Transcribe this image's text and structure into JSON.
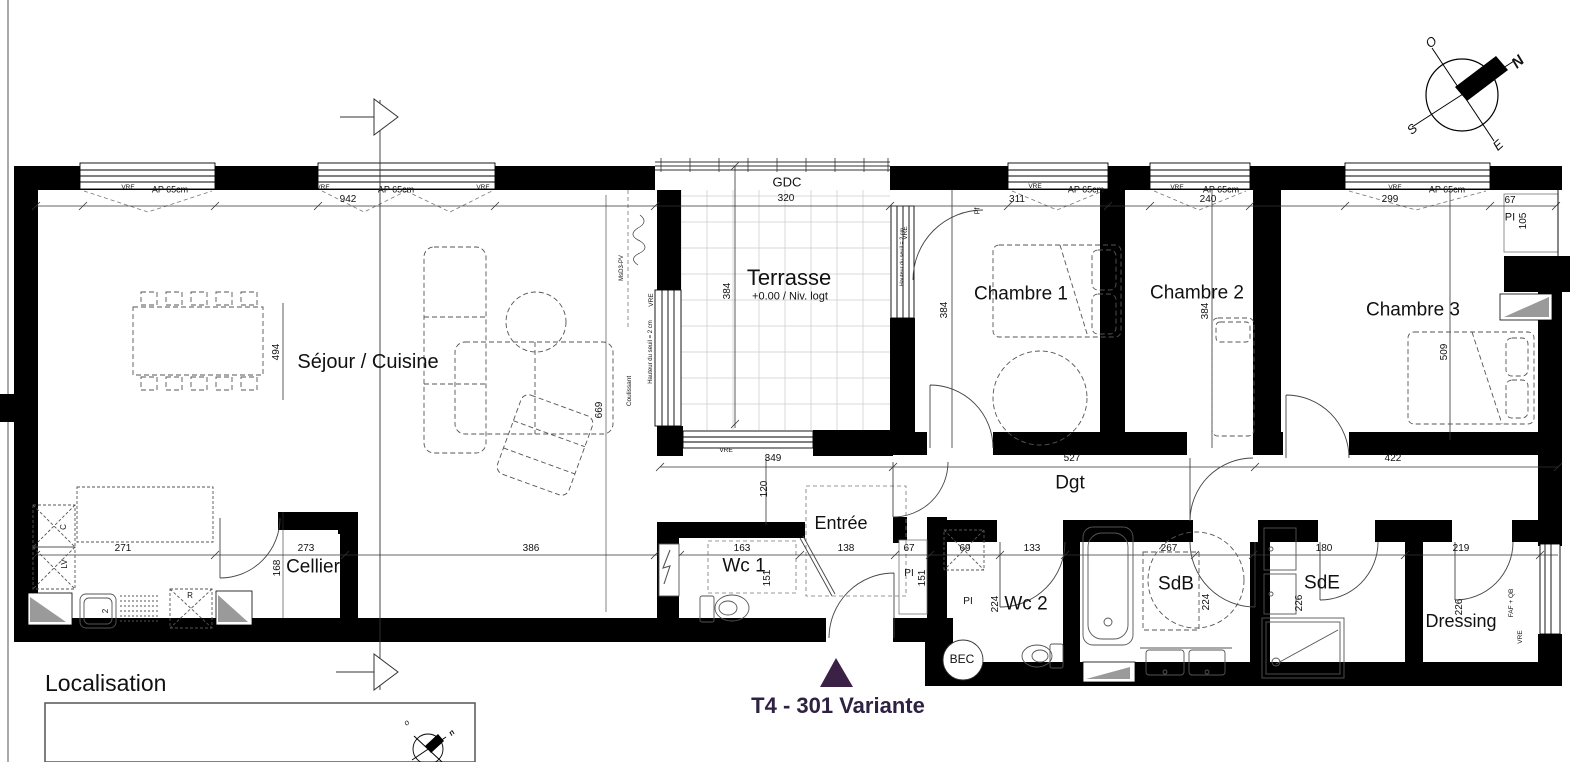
{
  "colors": {
    "wall": "#000000",
    "title": "#2f2142",
    "triangle": "#3a2145",
    "line": "#333333",
    "furniture": "#555555",
    "grid": "#cccccc",
    "gray_fill": "#9a9a9a"
  },
  "title_block": {
    "variant_title": "T4 - 301 Variante"
  },
  "localisation": {
    "heading": "Localisation"
  },
  "compass": {
    "north": "N",
    "south": "S",
    "east": "E",
    "west": "O"
  },
  "plan": {
    "labels": [
      {
        "n": "sejour-cuisine-label",
        "t": "Séjour / Cuisine",
        "x": 368,
        "y": 362,
        "s": 20
      },
      {
        "n": "cellier-label",
        "t": "Cellier",
        "x": 313,
        "y": 567,
        "s": 19
      },
      {
        "n": "terrasse-label",
        "t": "Terrasse",
        "x": 789,
        "y": 278,
        "s": 22
      },
      {
        "n": "terrasse-level-label",
        "t": "+0.00 / Niv. logt",
        "x": 790,
        "y": 297,
        "s": 11
      },
      {
        "n": "gdc-label",
        "t": "GDC",
        "x": 787,
        "y": 182,
        "s": 13
      },
      {
        "n": "chambre1-label",
        "t": "Chambre 1",
        "x": 1021,
        "y": 294,
        "s": 19
      },
      {
        "n": "chambre2-label",
        "t": "Chambre 2",
        "x": 1197,
        "y": 293,
        "s": 19
      },
      {
        "n": "chambre3-label",
        "t": "Chambre 3",
        "x": 1413,
        "y": 310,
        "s": 19
      },
      {
        "n": "dgt-label",
        "t": "Dgt",
        "x": 1070,
        "y": 483,
        "s": 19
      },
      {
        "n": "entree-label",
        "t": "Entrée",
        "x": 841,
        "y": 523,
        "s": 18
      },
      {
        "n": "wc1-label",
        "t": "Wc 1",
        "x": 744,
        "y": 566,
        "s": 19
      },
      {
        "n": "wc2-label",
        "t": "Wc 2",
        "x": 1026,
        "y": 604,
        "s": 19
      },
      {
        "n": "sdb-label",
        "t": "SdB",
        "x": 1176,
        "y": 584,
        "s": 19
      },
      {
        "n": "sde-label",
        "t": "SdE",
        "x": 1322,
        "y": 583,
        "s": 19
      },
      {
        "n": "dressing-label",
        "t": "Dressing",
        "x": 1461,
        "y": 621,
        "s": 18
      },
      {
        "n": "bec-label",
        "t": "BEC",
        "x": 962,
        "y": 659,
        "s": 12
      },
      {
        "n": "dim-942",
        "t": "942",
        "x": 348,
        "y": 200,
        "s": 10
      },
      {
        "n": "dim-320",
        "t": "320",
        "x": 786,
        "y": 199,
        "s": 10
      },
      {
        "n": "dim-311",
        "t": "311",
        "x": 1017,
        "y": 200,
        "s": 10
      },
      {
        "n": "dim-240",
        "t": "240",
        "x": 1208,
        "y": 200,
        "s": 10
      },
      {
        "n": "dim-299",
        "t": "299",
        "x": 1390,
        "y": 200,
        "s": 10
      },
      {
        "n": "dim-67-top",
        "t": "67",
        "x": 1510,
        "y": 201,
        "s": 10
      },
      {
        "n": "dim-349",
        "t": "349",
        "x": 773,
        "y": 459,
        "s": 10
      },
      {
        "n": "dim-527",
        "t": "527",
        "x": 1072,
        "y": 459,
        "s": 10
      },
      {
        "n": "dim-422",
        "t": "422",
        "x": 1393,
        "y": 459,
        "s": 10
      },
      {
        "n": "dim-271",
        "t": "271",
        "x": 123,
        "y": 549,
        "s": 10
      },
      {
        "n": "dim-273",
        "t": "273",
        "x": 306,
        "y": 549,
        "s": 10
      },
      {
        "n": "dim-386",
        "t": "386",
        "x": 531,
        "y": 549,
        "s": 10
      },
      {
        "n": "dim-163",
        "t": "163",
        "x": 742,
        "y": 549,
        "s": 10
      },
      {
        "n": "dim-138",
        "t": "138",
        "x": 846,
        "y": 549,
        "s": 10
      },
      {
        "n": "dim-67-entree",
        "t": "67",
        "x": 909,
        "y": 549,
        "s": 10
      },
      {
        "n": "dim-69",
        "t": "69",
        "x": 965,
        "y": 549,
        "s": 10
      },
      {
        "n": "dim-133",
        "t": "133",
        "x": 1032,
        "y": 549,
        "s": 10
      },
      {
        "n": "dim-267",
        "t": "267",
        "x": 1169,
        "y": 549,
        "s": 10
      },
      {
        "n": "dim-180",
        "t": "180",
        "x": 1324,
        "y": 549,
        "s": 10
      },
      {
        "n": "dim-219",
        "t": "219",
        "x": 1461,
        "y": 549,
        "s": 10
      },
      {
        "n": "ap65-window1",
        "t": "AP 65cm",
        "x": 170,
        "y": 190,
        "s": 9
      },
      {
        "n": "ap65-window2",
        "t": "AP 65cm",
        "x": 396,
        "y": 190,
        "s": 9
      },
      {
        "n": "ap65-chambre1",
        "t": "AP 65cm",
        "x": 1086,
        "y": 190,
        "s": 9
      },
      {
        "n": "ap65-chambre2",
        "t": "AP 65cm",
        "x": 1221,
        "y": 190,
        "s": 9
      },
      {
        "n": "ap65-chambre3",
        "t": "AP 65cm",
        "x": 1447,
        "y": 190,
        "s": 9
      },
      {
        "n": "vre-1",
        "t": "VRE",
        "x": 128,
        "y": 188,
        "s": 6.5
      },
      {
        "n": "vre-2",
        "t": "VRE",
        "x": 323,
        "y": 188,
        "s": 6.5
      },
      {
        "n": "vre-3",
        "t": "VRE",
        "x": 483,
        "y": 188,
        "s": 6.5
      },
      {
        "n": "vre-4",
        "t": "VRE",
        "x": 1035,
        "y": 187,
        "s": 6.5
      },
      {
        "n": "vre-5",
        "t": "VRE",
        "x": 1177,
        "y": 188,
        "s": 6.5
      },
      {
        "n": "vre-6",
        "t": "VRE",
        "x": 1395,
        "y": 188,
        "s": 6.5
      },
      {
        "n": "vre-terrasse-bas",
        "t": "VRE",
        "x": 726,
        "y": 451,
        "s": 6.5
      },
      {
        "n": "vre-terrasse-gauche",
        "t": "VRE",
        "x": 652,
        "y": 300,
        "s": 6.5,
        "r": -90
      },
      {
        "n": "vre-chambre1-pf",
        "t": "VRE",
        "x": 906,
        "y": 233,
        "s": 6.5,
        "r": -90
      },
      {
        "n": "vre-dressing",
        "t": "VRE",
        "x": 1521,
        "y": 637,
        "s": 6.5,
        "r": -90
      },
      {
        "n": "dim-494",
        "t": "494",
        "x": 277,
        "y": 352,
        "s": 10,
        "r": -90
      },
      {
        "n": "dim-669",
        "t": "669",
        "x": 600,
        "y": 410,
        "s": 10,
        "r": -90
      },
      {
        "n": "dim-384-terrasse",
        "t": "384",
        "x": 728,
        "y": 291,
        "s": 10,
        "r": -90
      },
      {
        "n": "dim-384-ch1",
        "t": "384",
        "x": 945,
        "y": 310,
        "s": 10,
        "r": -90
      },
      {
        "n": "dim-384-ch2",
        "t": "384",
        "x": 1206,
        "y": 311,
        "s": 10,
        "r": -90
      },
      {
        "n": "dim-509",
        "t": "509",
        "x": 1445,
        "y": 352,
        "s": 10,
        "r": -90
      },
      {
        "n": "dim-120",
        "t": "120",
        "x": 765,
        "y": 489,
        "s": 10,
        "r": -90
      },
      {
        "n": "dim-168",
        "t": "168",
        "x": 278,
        "y": 568,
        "s": 10,
        "r": -90
      },
      {
        "n": "dim-151-wc1",
        "t": "151",
        "x": 768,
        "y": 578,
        "s": 10,
        "r": -90
      },
      {
        "n": "dim-151-pi",
        "t": "151",
        "x": 923,
        "y": 578,
        "s": 10,
        "r": -90
      },
      {
        "n": "dim-224-wc2",
        "t": "224",
        "x": 996,
        "y": 604,
        "s": 10,
        "r": -90
      },
      {
        "n": "dim-224-sdb",
        "t": "224",
        "x": 1207,
        "y": 602,
        "s": 10,
        "r": -90
      },
      {
        "n": "dim-226-sde",
        "t": "226",
        "x": 1300,
        "y": 603,
        "s": 10,
        "r": -90
      },
      {
        "n": "dim-226-dressing",
        "t": "226",
        "x": 1460,
        "y": 607,
        "s": 10,
        "r": -90
      },
      {
        "n": "dim-105",
        "t": "105",
        "x": 1524,
        "y": 221,
        "s": 10,
        "r": -90
      },
      {
        "n": "pi-entree",
        "t": "PI",
        "x": 909,
        "y": 574,
        "s": 10
      },
      {
        "n": "pi-wc2",
        "t": "PI",
        "x": 968,
        "y": 602,
        "s": 10
      },
      {
        "n": "pi-chambre3",
        "t": "PI",
        "x": 1510,
        "y": 218,
        "s": 11
      },
      {
        "n": "pf-chambre1",
        "t": "Pf",
        "x": 978,
        "y": 211,
        "s": 7,
        "r": -90
      },
      {
        "n": "kitchen-c",
        "t": "C",
        "x": 64,
        "y": 527,
        "s": 8,
        "r": -90
      },
      {
        "n": "kitchen-lv",
        "t": "LV",
        "x": 65,
        "y": 564,
        "s": 8,
        "r": -90
      },
      {
        "n": "kitchen-r",
        "t": "R",
        "x": 190,
        "y": 596,
        "s": 8
      },
      {
        "n": "kitchen-sink-2",
        "t": "2",
        "x": 106,
        "y": 611,
        "s": 8,
        "r": -90
      },
      {
        "n": "faf-qb-note",
        "t": "FAF + QB",
        "x": 1512,
        "y": 603,
        "s": 6.5,
        "r": -90
      },
      {
        "n": "coulissant-note",
        "t": "Coulissant",
        "x": 630,
        "y": 391,
        "s": 6.5,
        "r": -90
      },
      {
        "n": "seuil-note-terrasse",
        "t": "Hauteur du seuil = 2 cm",
        "x": 651,
        "y": 352,
        "s": 6,
        "r": -90
      },
      {
        "n": "seuil-note-ch1",
        "t": "Hauteur du seuil = 2 cm",
        "x": 903,
        "y": 257,
        "s": 5.5,
        "r": -90
      },
      {
        "n": "pv-note",
        "t": "MsD3-PV",
        "x": 622,
        "y": 268,
        "s": 6,
        "r": -90
      },
      {
        "n": "compass-n",
        "t": "N",
        "x": 1518,
        "y": 62,
        "s": 15,
        "r": -42,
        "b": 1,
        "i": 1
      },
      {
        "n": "compass-o",
        "t": "O",
        "x": 1431,
        "y": 42,
        "s": 13,
        "r": -42,
        "i": 1
      },
      {
        "n": "compass-s",
        "t": "S",
        "x": 1412,
        "y": 129,
        "s": 13,
        "r": -42,
        "i": 1
      },
      {
        "n": "compass-e",
        "t": "E",
        "x": 1498,
        "y": 145,
        "s": 13,
        "r": -42,
        "i": 1
      },
      {
        "n": "mini-compass-o",
        "t": "o",
        "x": 407,
        "y": 723,
        "s": 8,
        "r": -42,
        "i": 1
      },
      {
        "n": "mini-compass-n",
        "t": "n",
        "x": 452,
        "y": 733,
        "s": 8,
        "r": -42,
        "b": 1,
        "i": 1
      }
    ]
  }
}
